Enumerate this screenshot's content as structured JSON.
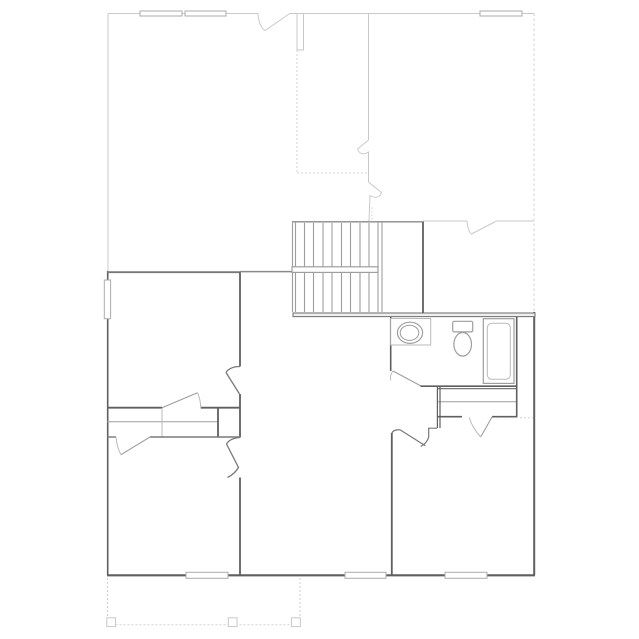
{
  "canvas": {
    "width": 639,
    "height": 639,
    "background": "#ffffff"
  },
  "colors": {
    "bg": "#ffffff",
    "wallDark": "#5f5f5f",
    "wall2": "#787878",
    "wallMed": "#8a8a8a",
    "fixture": "#9e9e9e",
    "fixtureLight": "#b9b9b9",
    "roof": "#c9c9c9",
    "dashc": "#d0d0d0",
    "window": "#ababab",
    "bandFill": "#efefef"
  },
  "elements": [
    {
      "name": "roof-top-edge-left",
      "type": "line",
      "x1": 108,
      "y1": 13.5,
      "x2": 258,
      "y2": 13.5,
      "stroke": "roof",
      "sw": 1
    },
    {
      "name": "roof-opening-mark-top",
      "type": "path",
      "d": "M258,13.5 C258.5,21 260.5,27.5 265,30.5 L289,14",
      "stroke": "roof",
      "sw": 1
    },
    {
      "name": "roof-top-edge-right",
      "type": "line",
      "x1": 289,
      "y1": 13.5,
      "x2": 534,
      "y2": 13.5,
      "stroke": "roof",
      "sw": 1
    },
    {
      "name": "roof-left-edge",
      "type": "line",
      "x1": 108,
      "y1": 13.5,
      "x2": 108,
      "y2": 271,
      "stroke": "roof",
      "sw": 1
    },
    {
      "name": "chimney-outline",
      "type": "rect",
      "x": 297,
      "y": 13.5,
      "w": 6.5,
      "h": 36.5,
      "stroke": "roof",
      "sw": 1,
      "fill": "bg"
    },
    {
      "name": "roof-ridge-dotted-vertical",
      "type": "line",
      "x1": 297,
      "y1": 50,
      "x2": 297,
      "y2": 173,
      "stroke": "dashc",
      "sw": 1,
      "dash": "2,2"
    },
    {
      "name": "roof-ridge-dotted-horizontal",
      "type": "line",
      "x1": 297,
      "y1": 173,
      "x2": 368.5,
      "y2": 173,
      "stroke": "dashc",
      "sw": 1,
      "dash": "2,2"
    },
    {
      "name": "roof-inner-wall-vertical",
      "type": "line",
      "x1": 368.5,
      "y1": 13.5,
      "x2": 368.5,
      "y2": 140,
      "stroke": "roof",
      "sw": 1
    },
    {
      "name": "roof-break-mark-upper",
      "type": "path",
      "d": "M368.5,140 L357.5,149 C359.5,154.5 364,155 368.5,152 L368.5,182",
      "stroke": "roof",
      "sw": 1
    },
    {
      "name": "roof-break-mark-lower",
      "type": "path",
      "d": "M368.5,182 L381.5,192.5 C379.5,198 375,198.5 370,195.5 L369,221",
      "stroke": "roof",
      "sw": 1
    },
    {
      "name": "roof-wall-221-left",
      "type": "line",
      "x1": 423,
      "y1": 221,
      "x2": 467,
      "y2": 221,
      "stroke": "roof",
      "sw": 1
    },
    {
      "name": "roof-opening-mark-221",
      "type": "path",
      "d": "M467,221 C467.5,227.5 469,232 471.5,234 L495.5,221.5",
      "stroke": "roof",
      "sw": 1
    },
    {
      "name": "roof-wall-221-right",
      "type": "line",
      "x1": 495.5,
      "y1": 221,
      "x2": 534,
      "y2": 221,
      "stroke": "roof",
      "sw": 1
    },
    {
      "name": "roof-right-dashed-edge",
      "type": "line",
      "x1": 534,
      "y1": 13.5,
      "x2": 534,
      "y2": 311,
      "stroke": "dashc",
      "sw": 1,
      "dash": "2.5,2.5"
    },
    {
      "name": "roof-dotted-stair-tail",
      "type": "line",
      "x1": 372,
      "y1": 207.5,
      "x2": 372,
      "y2": 221,
      "stroke": "dashc",
      "sw": 1,
      "dash": "1.5,2"
    },
    {
      "name": "window-top-1",
      "type": "rect",
      "x": 140,
      "y": 11,
      "w": 42,
      "h": 5,
      "stroke": "window",
      "sw": 1,
      "fill": "bg"
    },
    {
      "name": "window-top-2",
      "type": "rect",
      "x": 185,
      "y": 11,
      "w": 41,
      "h": 5,
      "stroke": "window",
      "sw": 1,
      "fill": "bg"
    },
    {
      "name": "window-top-3",
      "type": "rect",
      "x": 480,
      "y": 11,
      "w": 42,
      "h": 5,
      "stroke": "window",
      "sw": 1,
      "fill": "bg"
    },
    {
      "name": "wall-left-exterior",
      "type": "line",
      "x1": 107.7,
      "y1": 271,
      "x2": 107.7,
      "y2": 575,
      "stroke": "wallDark",
      "sw": 1.6
    },
    {
      "name": "wall-top-left-room",
      "type": "line",
      "x1": 107,
      "y1": 272.2,
      "x2": 240.5,
      "y2": 272.2,
      "stroke": "wall2",
      "sw": 1.8
    },
    {
      "name": "wall-center-upper",
      "type": "line",
      "x1": 240,
      "y1": 272.2,
      "x2": 240,
      "y2": 366.5,
      "stroke": "wallDark",
      "sw": 1.8
    },
    {
      "name": "opening-mark-center-upper",
      "type": "path",
      "d": "M240,366.5 C233,366.5 228,369 226,372.5 M226,372.5 L239.5,394",
      "stroke": "wall2",
      "sw": 1.3
    },
    {
      "name": "wall-center-middle",
      "type": "line",
      "x1": 240,
      "y1": 394,
      "x2": 240,
      "y2": 437.5,
      "stroke": "wallDark",
      "sw": 1.8
    },
    {
      "name": "opening-mark-center-lower",
      "type": "path",
      "d": "M240,437.5 C233,438 228.5,440.5 226.5,444 M226.5,444 L238.5,467.5 C235.5,472.5 231.5,475.5 227.5,477.5",
      "stroke": "wall2",
      "sw": 1.3
    },
    {
      "name": "wall-center-lower",
      "type": "line",
      "x1": 240,
      "y1": 477.5,
      "x2": 240,
      "y2": 575,
      "stroke": "wallDark",
      "sw": 1.8
    },
    {
      "name": "wall-bottom-exterior",
      "type": "line",
      "x1": 107,
      "y1": 575.3,
      "x2": 535,
      "y2": 575.3,
      "stroke": "wallDark",
      "sw": 2.2
    },
    {
      "name": "window-bottom-1",
      "type": "rect",
      "x": 186,
      "y": 572.3,
      "w": 42,
      "h": 6,
      "stroke": "window",
      "sw": 1,
      "fill": "bg"
    },
    {
      "name": "window-bottom-2",
      "type": "rect",
      "x": 345,
      "y": 572.3,
      "w": 41,
      "h": 6,
      "stroke": "window",
      "sw": 1,
      "fill": "bg"
    },
    {
      "name": "window-bottom-3",
      "type": "rect",
      "x": 445,
      "y": 572.3,
      "w": 42,
      "h": 6,
      "stroke": "window",
      "sw": 1,
      "fill": "bg"
    },
    {
      "name": "wall-right-exterior",
      "type": "line",
      "x1": 534.2,
      "y1": 312,
      "x2": 534.2,
      "y2": 575,
      "stroke": "wallDark",
      "sw": 2
    },
    {
      "name": "wall-band-bath-top",
      "type": "rect",
      "x": 293,
      "y": 313,
      "w": 242,
      "h": 3.6,
      "stroke": "wall2",
      "sw": 1.1,
      "fill": "bandFill"
    },
    {
      "name": "wall-stairwell-east",
      "type": "line",
      "x1": 423,
      "y1": 221.5,
      "x2": 423,
      "y2": 313,
      "stroke": "wallDark",
      "sw": 1.8
    },
    {
      "name": "stair-top-edge",
      "type": "line",
      "x1": 292,
      "y1": 221.8,
      "x2": 423,
      "y2": 221.8,
      "stroke": "wallMed",
      "sw": 1.4
    },
    {
      "name": "stair-stringer-left-outer",
      "type": "line",
      "x1": 292.5,
      "y1": 222,
      "x2": 292.5,
      "y2": 312,
      "stroke": "fixture",
      "sw": 1.1
    },
    {
      "name": "stair-stringer-left-inner",
      "type": "line",
      "x1": 295.5,
      "y1": 222,
      "x2": 295.5,
      "y2": 312,
      "stroke": "fixture",
      "sw": 1.1
    },
    {
      "name": "stair-tread-1",
      "type": "line",
      "x1": 304.5,
      "y1": 223,
      "x2": 304.5,
      "y2": 312,
      "stroke": "fixture",
      "sw": 1.1
    },
    {
      "name": "stair-tread-2",
      "type": "line",
      "x1": 313.5,
      "y1": 223,
      "x2": 313.5,
      "y2": 312,
      "stroke": "fixture",
      "sw": 1.1
    },
    {
      "name": "stair-tread-3",
      "type": "line",
      "x1": 323,
      "y1": 223,
      "x2": 323,
      "y2": 312,
      "stroke": "fixture",
      "sw": 1.1
    },
    {
      "name": "stair-tread-4",
      "type": "line",
      "x1": 332,
      "y1": 223,
      "x2": 332,
      "y2": 312,
      "stroke": "fixture",
      "sw": 1.1
    },
    {
      "name": "stair-tread-5",
      "type": "line",
      "x1": 341.5,
      "y1": 223,
      "x2": 341.5,
      "y2": 312,
      "stroke": "fixture",
      "sw": 1.1
    },
    {
      "name": "stair-tread-6",
      "type": "line",
      "x1": 350.5,
      "y1": 223,
      "x2": 350.5,
      "y2": 312,
      "stroke": "fixture",
      "sw": 1.1
    },
    {
      "name": "stair-tread-7",
      "type": "line",
      "x1": 360,
      "y1": 223,
      "x2": 360,
      "y2": 312,
      "stroke": "fixture",
      "sw": 1.1
    },
    {
      "name": "stair-tread-8",
      "type": "line",
      "x1": 369,
      "y1": 223,
      "x2": 369,
      "y2": 312,
      "stroke": "fixture",
      "sw": 1.1
    },
    {
      "name": "stair-stringer-right-inner",
      "type": "line",
      "x1": 378,
      "y1": 222,
      "x2": 378,
      "y2": 312,
      "stroke": "fixture",
      "sw": 1.1
    },
    {
      "name": "stair-stringer-right-outer",
      "type": "line",
      "x1": 382,
      "y1": 222,
      "x2": 382,
      "y2": 312,
      "stroke": "fixture",
      "sw": 1.1
    },
    {
      "name": "stair-rail-hall-segment",
      "type": "line",
      "x1": 240,
      "y1": 271.6,
      "x2": 292,
      "y2": 271.6,
      "stroke": "wallMed",
      "sw": 1.5
    },
    {
      "name": "stair-handrail",
      "type": "rect",
      "x": 292,
      "y": 266.8,
      "w": 86,
      "h": 5.6,
      "stroke": "fixture",
      "sw": 1.2,
      "fill": "bg"
    },
    {
      "name": "wall-bath-west",
      "type": "line",
      "x1": 390.7,
      "y1": 317,
      "x2": 390.7,
      "y2": 371,
      "stroke": "wallDark",
      "sw": 1.6
    },
    {
      "name": "bath-door-leaf",
      "type": "line",
      "x1": 421,
      "y1": 386,
      "x2": 393,
      "y2": 371,
      "stroke": "fixture",
      "sw": 1.1
    },
    {
      "name": "bath-door-swing-arc",
      "type": "path",
      "d": "M393,371 Q389.5,375.5 390.7,380.5",
      "stroke": "fixtureLight",
      "sw": 1
    },
    {
      "name": "wall-bath-south",
      "type": "line",
      "x1": 420.5,
      "y1": 386.2,
      "x2": 516.5,
      "y2": 386.2,
      "stroke": "wallDark",
      "sw": 1.6
    },
    {
      "name": "wall-closet-north",
      "type": "line",
      "x1": 437,
      "y1": 388.6,
      "x2": 516.5,
      "y2": 388.6,
      "stroke": "wall2",
      "sw": 1.2
    },
    {
      "name": "bath-vanity-counter",
      "type": "rect",
      "x": 390.7,
      "y": 318.5,
      "w": 40,
      "h": 26.5,
      "stroke": "fixtureLight",
      "sw": 1,
      "fill": "bg"
    },
    {
      "name": "bath-sink-outer-rim",
      "type": "ellipse",
      "cx": 410,
      "cy": 332.8,
      "rx": 12.6,
      "ry": 10.6,
      "stroke": "fixture",
      "sw": 1.2,
      "fill": "bg"
    },
    {
      "name": "bath-sink-inner-basin",
      "type": "ellipse",
      "cx": 409.5,
      "cy": 332.8,
      "rx": 9.3,
      "ry": 7.6,
      "stroke": "fixture",
      "sw": 1
    },
    {
      "name": "toilet-tank",
      "type": "rect",
      "x": 452.7,
      "y": 321.3,
      "w": 20,
      "h": 10.6,
      "rx": 1.5,
      "stroke": "fixture",
      "sw": 1.2,
      "fill": "bg"
    },
    {
      "name": "toilet-bowl",
      "type": "ellipse",
      "cx": 462.7,
      "cy": 344.3,
      "rx": 8.8,
      "ry": 11.8,
      "stroke": "fixture",
      "sw": 1.2,
      "fill": "bg"
    },
    {
      "name": "bathtub-outer",
      "type": "rect",
      "x": 483.3,
      "y": 318.7,
      "w": 30.7,
      "h": 64.7,
      "stroke": "fixture",
      "sw": 1.2,
      "fill": "bg"
    },
    {
      "name": "bathtub-inner",
      "type": "rect",
      "x": 487.3,
      "y": 323.3,
      "w": 23,
      "h": 56,
      "rx": 4.5,
      "stroke": "fixtureLight",
      "sw": 1
    },
    {
      "name": "wall-bath-east",
      "type": "line",
      "x1": 516.7,
      "y1": 317,
      "x2": 516.7,
      "y2": 417,
      "stroke": "wallDark",
      "sw": 1.6
    },
    {
      "name": "closet-shelf-line",
      "type": "line",
      "x1": 438,
      "y1": 401.7,
      "x2": 516,
      "y2": 401.7,
      "stroke": "fixture",
      "sw": 1
    },
    {
      "name": "wall-closet-south-left",
      "type": "line",
      "x1": 437,
      "y1": 416.7,
      "x2": 462,
      "y2": 416.7,
      "stroke": "wallDark",
      "sw": 1.6
    },
    {
      "name": "wall-closet-south-right",
      "type": "line",
      "x1": 492,
      "y1": 416.7,
      "x2": 517,
      "y2": 416.7,
      "stroke": "wallDark",
      "sw": 1.6
    },
    {
      "name": "bedroom-closet-door-leaf",
      "type": "line",
      "x1": 492,
      "y1": 417,
      "x2": 480.7,
      "y2": 437,
      "stroke": "fixture",
      "sw": 1.1
    },
    {
      "name": "bedroom-closet-door-arc",
      "type": "path",
      "d": "M480.7,437 Q472,427.5 469.3,417.5",
      "stroke": "fixtureLight",
      "sw": 1
    },
    {
      "name": "bedroom-north-dashed-line",
      "type": "line",
      "x1": 492,
      "y1": 417.7,
      "x2": 533,
      "y2": 417.7,
      "stroke": "dashc",
      "sw": 1,
      "dash": "2,2"
    },
    {
      "name": "wall-closet-west-outer",
      "type": "line",
      "x1": 437.4,
      "y1": 387,
      "x2": 437.4,
      "y2": 428,
      "stroke": "wallDark",
      "sw": 1.2
    },
    {
      "name": "wall-closet-west-inner",
      "type": "line",
      "x1": 440,
      "y1": 387,
      "x2": 440,
      "y2": 428,
      "stroke": "wallDark",
      "sw": 1.2
    },
    {
      "name": "opening-mark-bedroom-entry",
      "type": "path",
      "d": "M437,428.2 L428.7,428.2 L428.7,437 C427.5,441.5 424.5,444.5 420.7,446.5 M400,429.8 C395,429.5 392.5,431 391.8,433.5 M400,429.8 L425.3,445.8",
      "stroke": "wall2",
      "sw": 1.2
    },
    {
      "name": "wall-bedroom-west",
      "type": "line",
      "x1": 391.8,
      "y1": 433,
      "x2": 391.8,
      "y2": 575,
      "stroke": "wallDark",
      "sw": 1.8
    },
    {
      "name": "wall-left-closet-north-left",
      "type": "line",
      "x1": 107,
      "y1": 407.7,
      "x2": 162,
      "y2": 407.7,
      "stroke": "wallDark",
      "sw": 1.8
    },
    {
      "name": "wall-left-closet-north-right",
      "type": "line",
      "x1": 200.7,
      "y1": 407.7,
      "x2": 240.5,
      "y2": 407.7,
      "stroke": "wallDark",
      "sw": 1.8
    },
    {
      "name": "left-closet-door-leaf",
      "type": "line",
      "x1": 162,
      "y1": 407.7,
      "x2": 197.5,
      "y2": 392.7,
      "stroke": "fixture",
      "sw": 1.1
    },
    {
      "name": "left-closet-door-arc",
      "type": "path",
      "d": "M197.5,392.7 Q200.7,400 200.7,407.7",
      "stroke": "fixtureLight",
      "sw": 1
    },
    {
      "name": "left-closet-shelf-line",
      "type": "line",
      "x1": 107,
      "y1": 421.7,
      "x2": 217.5,
      "y2": 421.7,
      "stroke": "fixture",
      "sw": 1
    },
    {
      "name": "left-closet-divider",
      "type": "line",
      "x1": 162,
      "y1": 408,
      "x2": 162,
      "y2": 437,
      "stroke": "fixtureLight",
      "sw": 1
    },
    {
      "name": "wall-left-closet-east",
      "type": "line",
      "x1": 218,
      "y1": 407.7,
      "x2": 218,
      "y2": 437,
      "stroke": "wallDark",
      "sw": 1.8
    },
    {
      "name": "wall-left-closet-south-left",
      "type": "line",
      "x1": 107,
      "y1": 437,
      "x2": 116,
      "y2": 437,
      "stroke": "wall2",
      "sw": 1.4
    },
    {
      "name": "wall-left-closet-south-right",
      "type": "line",
      "x1": 150,
      "y1": 437,
      "x2": 240,
      "y2": 437,
      "stroke": "wall2",
      "sw": 1.4
    },
    {
      "name": "lower-closet-door-leaf",
      "type": "line",
      "x1": 150,
      "y1": 437,
      "x2": 121,
      "y2": 454.7,
      "stroke": "fixture",
      "sw": 1.1
    },
    {
      "name": "lower-closet-door-arc",
      "type": "path",
      "d": "M121,454.7 Q116.5,446.5 116.2,437.5",
      "stroke": "fixtureLight",
      "sw": 1
    },
    {
      "name": "window-left-wall",
      "type": "rect",
      "x": 104.3,
      "y": 280,
      "w": 6.3,
      "h": 38.7,
      "stroke": "window",
      "sw": 1,
      "fill": "bg"
    },
    {
      "name": "porch-left-dashed",
      "type": "line",
      "x1": 107.5,
      "y1": 578,
      "x2": 107.5,
      "y2": 624.7,
      "stroke": "dashc",
      "sw": 1,
      "dash": "2,2"
    },
    {
      "name": "porch-bottom-dashed",
      "type": "line",
      "x1": 107.5,
      "y1": 624.7,
      "x2": 300,
      "y2": 624.7,
      "stroke": "dashc",
      "sw": 1,
      "dash": "2,2"
    },
    {
      "name": "porch-right-dashed",
      "type": "line",
      "x1": 300,
      "y1": 578,
      "x2": 300,
      "y2": 624.7,
      "stroke": "dashc",
      "sw": 1,
      "dash": "2,2"
    },
    {
      "name": "porch-post-1",
      "type": "rect",
      "x": 106.8,
      "y": 617.8,
      "w": 8.8,
      "h": 8.8,
      "stroke": "roof",
      "sw": 1,
      "fill": "bg"
    },
    {
      "name": "porch-post-2",
      "type": "rect",
      "x": 228.3,
      "y": 617.8,
      "w": 8.8,
      "h": 8.8,
      "stroke": "roof",
      "sw": 1,
      "fill": "bg"
    },
    {
      "name": "porch-post-3",
      "type": "rect",
      "x": 291.5,
      "y": 617.8,
      "w": 8.8,
      "h": 8.8,
      "stroke": "roof",
      "sw": 1,
      "fill": "bg"
    }
  ]
}
